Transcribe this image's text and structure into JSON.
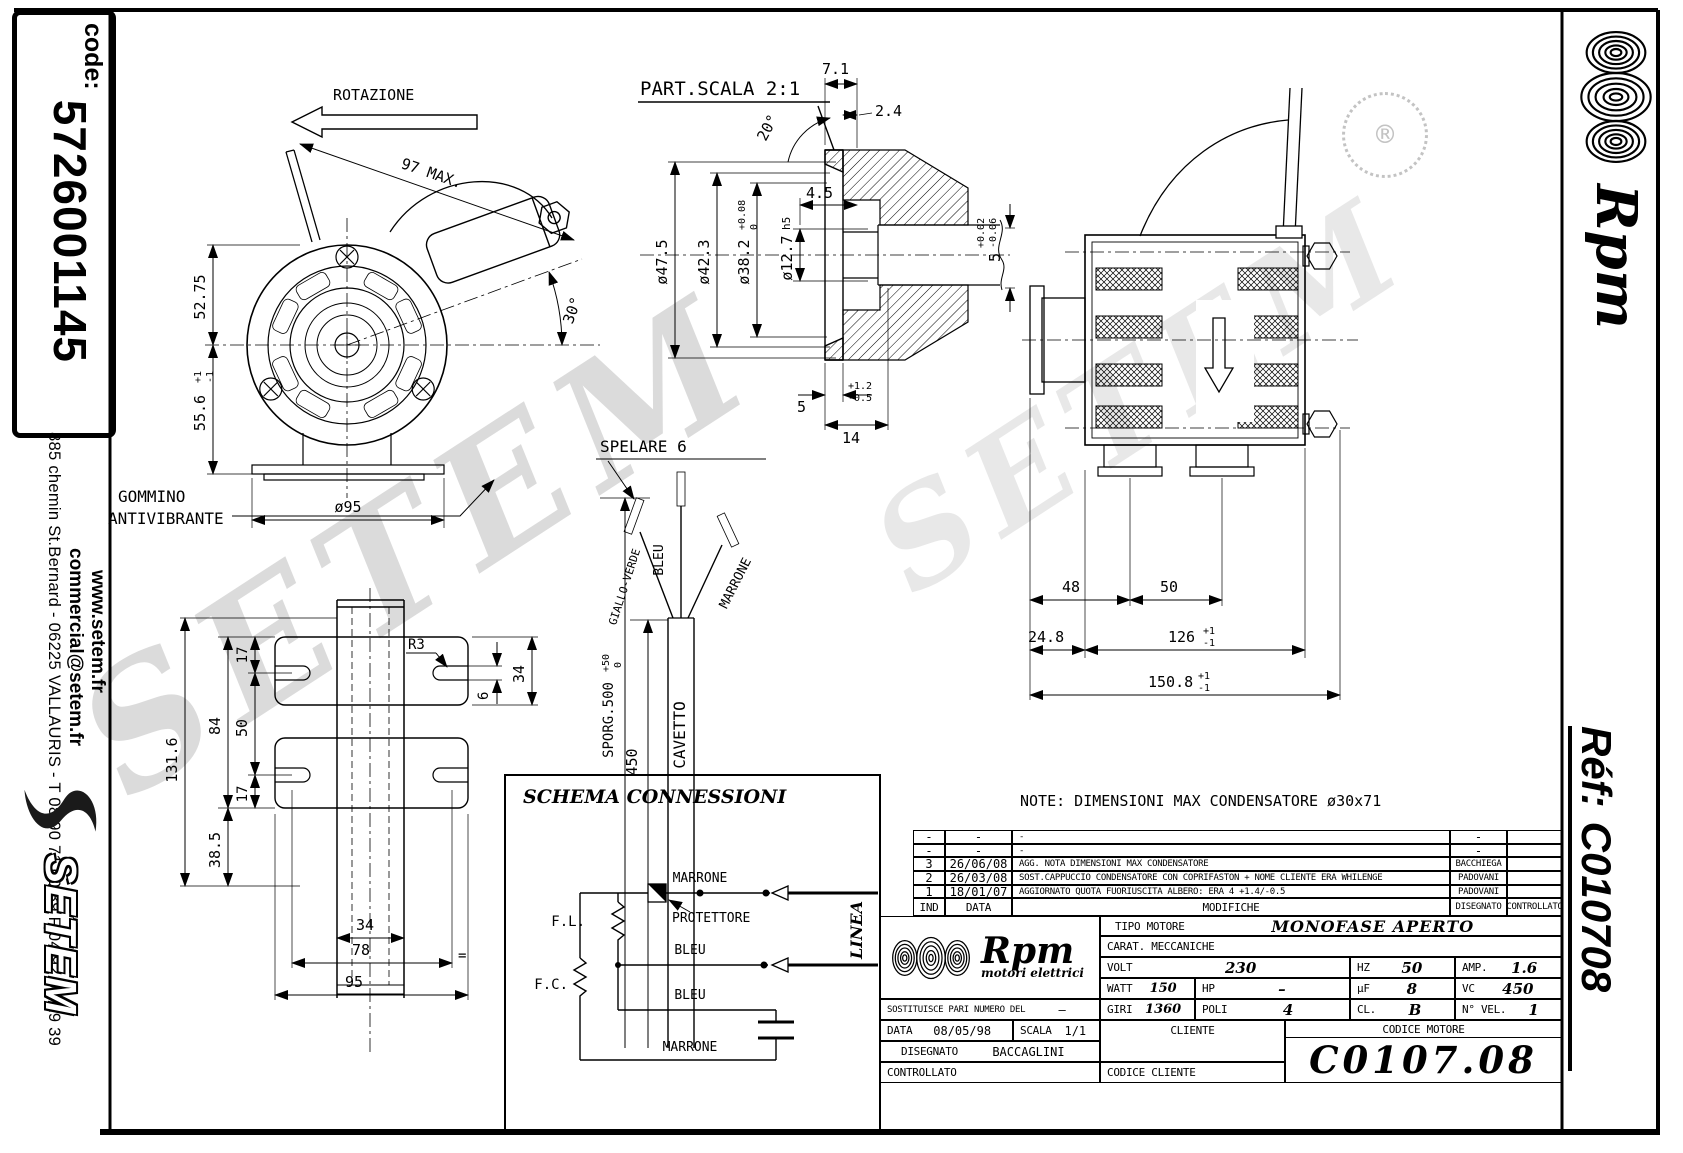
{
  "sheet": {
    "code_label": "code:",
    "code_value": "5726001145",
    "web": "www.setem.fr",
    "email": "commercial@setem.fr",
    "address": "885 chemin St.Bernard  -  06225 VALLAURIS  -  T 08 90 71 00 39  F 04 92 95 19 39",
    "setem_logo": "SETEM",
    "watermark": "SETEM",
    "reg_mark": "®",
    "ref_label": "Réf:",
    "ref_value": "C010708",
    "brand_name": "Rpm",
    "brand_tagline": "motori elettrici"
  },
  "front_view": {
    "rotazione": "ROTAZIONE",
    "dim_97": "97 MAX.",
    "dim_5275": "52.75",
    "dim_556": "55.6",
    "dim_556_tol_p": "+1",
    "dim_556_tol_m": "-1",
    "dim_d95": "ø95",
    "dim_30": "30°",
    "gommino_1": "GOMMINO",
    "gommino_2": "ANTIVIBRANTE"
  },
  "shaft_view": {
    "title": "PART.SCALA 2:1",
    "dim_71": "7.1",
    "dim_24": "2.4",
    "dim_20": "20°",
    "dim_45": "4.5",
    "dim_d475": "ø47.5",
    "dim_d423": "ø42.3",
    "dim_d382": "ø38.2",
    "dim_d382_tol_p": "+0.08",
    "dim_d382_tol_m": "0",
    "dim_d127": "ø12.7",
    "dim_d127_fit": "h5",
    "dim_5a": "5",
    "dim_5a_tol_p": "+1.2",
    "dim_5a_tol_m": "-0.5",
    "dim_14": "14",
    "dim_5b": "5",
    "dim_5b_tol_p": "+0.02",
    "dim_5b_tol_m": "-0.06"
  },
  "side_view": {
    "dim_48": "48",
    "dim_50": "50",
    "dim_248": "24.8",
    "dim_126": "126",
    "dim_126_tol_p": "+1",
    "dim_126_tol_m": "-1",
    "dim_1508": "150.8",
    "dim_1508_tol_p": "+1",
    "dim_1508_tol_m": "-1"
  },
  "bracket_view": {
    "dim_1316": "131.6",
    "dim_84": "84",
    "dim_50": "50",
    "dim_17a": "17",
    "dim_17b": "17",
    "dim_385": "38.5",
    "dim_r3": "R3",
    "dim_6": "6",
    "dim_34r": "34",
    "dim_34b": "34",
    "dim_78": "78",
    "dim_95": "95",
    "eq": "="
  },
  "cable_view": {
    "spelare": "SPELARE 6",
    "sporg": "SPORG.500",
    "sporg_tol_p": "+50",
    "sporg_tol_m": "0",
    "dim_450": "450",
    "cavetto": "CAVETTO",
    "wire_yellow_green": "GIALLO-VERDE",
    "wire_blue": "BLEU",
    "wire_brown": "MARRONE"
  },
  "note": "NOTE: DIMENSIONI MAX CONDENSATORE ø30x71",
  "schema": {
    "title": "SCHEMA CONNESSIONI",
    "fl": "F.L.",
    "fc": "F.C.",
    "protettore": "PROTETTORE",
    "wire1": "MARRONE",
    "wire2": "BLEU",
    "wire3": "BLEU",
    "wire4": "MARRONE",
    "linea": "LINEA"
  },
  "titleblock": {
    "revisions": [
      {
        "ind": "-",
        "data": "-",
        "modifiche": "-",
        "disegnato": "-",
        "controllato": ""
      },
      {
        "ind": "-",
        "data": "-",
        "modifiche": "-",
        "disegnato": "-",
        "controllato": ""
      },
      {
        "ind": "3",
        "data": "26/06/08",
        "modifiche": "AGG. NOTA DIMENSIONI MAX CONDENSATORE",
        "disegnato": "BACCHIEGA",
        "controllato": ""
      },
      {
        "ind": "2",
        "data": "26/03/08",
        "modifiche": "SOST.CAPPUCCIO CONDENSATORE CON COPRIFASTON + NOME CLIENTE ERA WHILENGE",
        "disegnato": "PADOVANI",
        "controllato": ""
      },
      {
        "ind": "1",
        "data": "18/01/07",
        "modifiche": "AGGIORNATO QUOTA FUORIUSCITA ALBERO: ERA 4 +1.4/-0.5",
        "disegnato": "PADOVANI",
        "controllato": ""
      }
    ],
    "rev_header": {
      "ind": "IND",
      "data": "DATA",
      "modifiche": "MODIFICHE",
      "disegnato": "DISEGNATO",
      "controllato": "CONTROLLATO"
    },
    "tipo_motore_label": "TIPO MOTORE",
    "tipo_motore_value": "MONOFASE APERTO",
    "carat": "CARAT. MECCANICHE",
    "volt_label": "VOLT",
    "volt_value": "230",
    "hz_label": "HZ",
    "hz_value": "50",
    "amp_label": "AMP.",
    "amp_value": "1.6",
    "watt_label": "WATT",
    "watt_value": "150",
    "hp_label": "HP",
    "hp_value": "–",
    "uf_label": "µF",
    "uf_value": "8",
    "vc_label": "VC",
    "vc_value": "450",
    "giri_label": "GIRI",
    "giri_value": "1360",
    "poli_label": "POLI",
    "poli_value": "4",
    "cl_label": "CL.",
    "cl_value": "B",
    "nvel_label": "N° VEL.",
    "nvel_value": "1",
    "sostituisce_label": "SOSTITUISCE PARI NUMERO DEL",
    "sostituisce_value": "–",
    "data_label": "DATA",
    "data_value": "08/05/98",
    "scala_label": "SCALA",
    "scala_value": "1/1",
    "disegnato_label": "DISEGNATO",
    "disegnato_value": "BACCAGLINI",
    "controllato_label": "CONTROLLATO",
    "cliente_label": "CLIENTE",
    "codice_cliente_label": "CODICE CLIENTE",
    "codice_motore_label": "CODICE MOTORE",
    "codice_motore_value": "C0107.08"
  }
}
